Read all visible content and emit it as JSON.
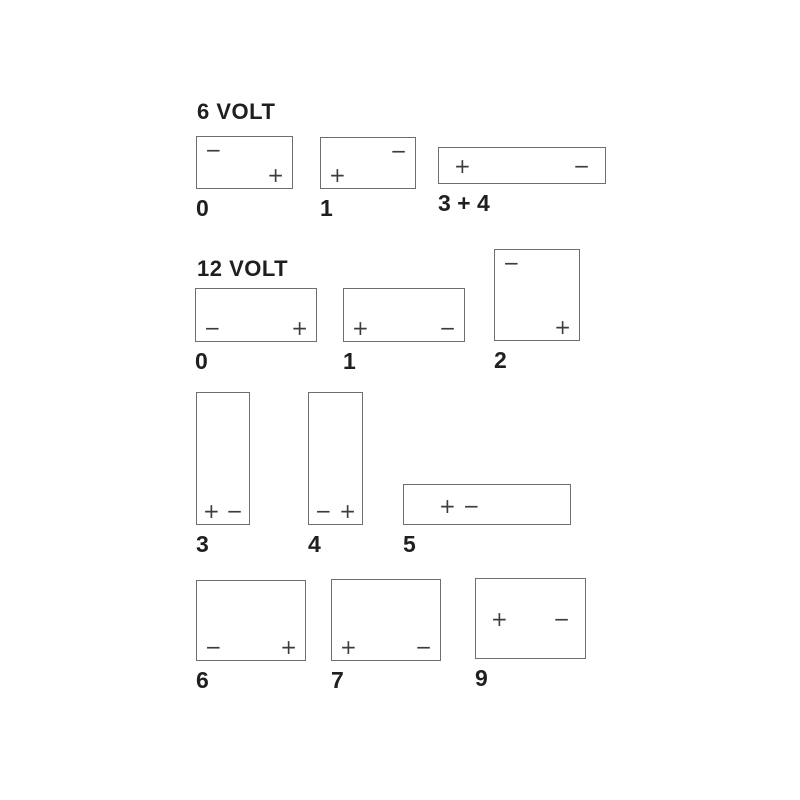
{
  "colors": {
    "background": "#ffffff",
    "outline": "#6e6e6e",
    "symbol": "#3c3c3c",
    "text": "#1f1f1f"
  },
  "sections": [
    {
      "heading": "6 VOLT",
      "batteries": [
        {
          "label": "0",
          "terminals": [
            {
              "symbol": "−",
              "position": "top-left"
            },
            {
              "symbol": "+",
              "position": "bottom-right"
            }
          ]
        },
        {
          "label": "1",
          "terminals": [
            {
              "symbol": "−",
              "position": "top-right"
            },
            {
              "symbol": "+",
              "position": "bottom-left"
            }
          ]
        },
        {
          "label": "3 + 4",
          "terminals": [
            {
              "symbol": "+",
              "position": "middle-left"
            },
            {
              "symbol": "−",
              "position": "middle-right"
            }
          ]
        }
      ]
    },
    {
      "heading": "12 VOLT",
      "batteries": [
        {
          "label": "0",
          "terminals": [
            {
              "symbol": "−",
              "position": "bottom-left"
            },
            {
              "symbol": "+",
              "position": "bottom-right"
            }
          ]
        },
        {
          "label": "1",
          "terminals": [
            {
              "symbol": "+",
              "position": "bottom-left"
            },
            {
              "symbol": "−",
              "position": "bottom-right"
            }
          ]
        },
        {
          "label": "2",
          "terminals": [
            {
              "symbol": "−",
              "position": "top-left"
            },
            {
              "symbol": "+",
              "position": "bottom-right"
            }
          ]
        },
        {
          "label": "3",
          "terminals": [
            {
              "symbol": "+",
              "position": "bottom-left"
            },
            {
              "symbol": "−",
              "position": "bottom-right"
            }
          ]
        },
        {
          "label": "4",
          "terminals": [
            {
              "symbol": "−",
              "position": "bottom-left"
            },
            {
              "symbol": "+",
              "position": "bottom-right"
            }
          ]
        },
        {
          "label": "5",
          "terminals": [
            {
              "symbol": "+",
              "position": "inner-left-first"
            },
            {
              "symbol": "−",
              "position": "inner-left-second"
            }
          ]
        },
        {
          "label": "6",
          "terminals": [
            {
              "symbol": "−",
              "position": "bottom-left"
            },
            {
              "symbol": "+",
              "position": "bottom-right"
            }
          ]
        },
        {
          "label": "7",
          "terminals": [
            {
              "symbol": "+",
              "position": "bottom-left"
            },
            {
              "symbol": "−",
              "position": "bottom-right"
            }
          ]
        },
        {
          "label": "9",
          "terminals": [
            {
              "symbol": "+",
              "position": "middle-left"
            },
            {
              "symbol": "−",
              "position": "middle-right"
            }
          ]
        }
      ]
    }
  ]
}
